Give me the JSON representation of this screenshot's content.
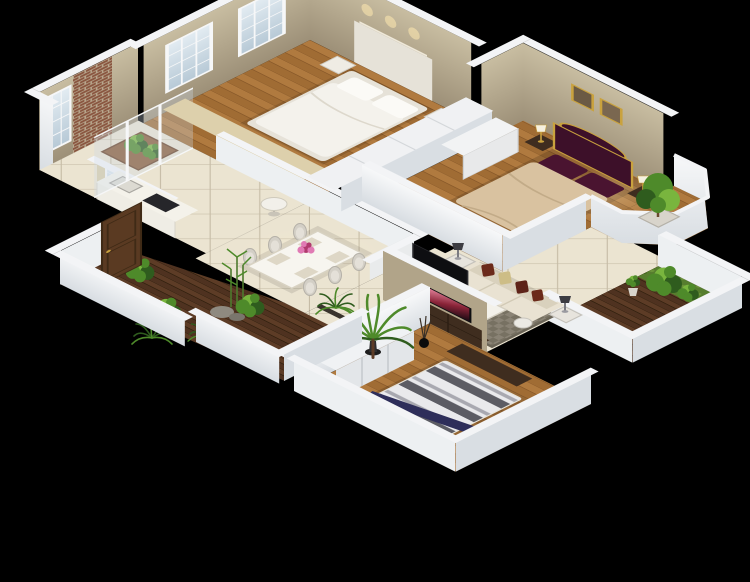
{
  "scene": {
    "description": "3D isometric cutaway render of a three-bedroom apartment floor plan on a black background",
    "rooms": [
      {
        "name": "kitchen-balcony",
        "features": [
          "brick-wall",
          "grid-windows",
          "counter-with-sink-and-cooktop",
          "planter-box",
          "glass-partition"
        ]
      },
      {
        "name": "bedroom-1",
        "features": [
          "white-double-bed",
          "two-grid-windows",
          "headboard-wall-with-downlights",
          "beige-low-cabinet"
        ]
      },
      {
        "name": "master-bedroom",
        "features": [
          "purple-ornate-headboard-bed",
          "tan-bedspread",
          "two-framed-pictures",
          "nightstands-with-lamps",
          "white-dresser"
        ]
      },
      {
        "name": "bay-balcony",
        "features": [
          "potted-tree",
          "white-parapet"
        ]
      },
      {
        "name": "dining-area",
        "features": [
          "white-dining-table",
          "six-upholstered-chairs",
          "magenta-flower-centerpiece",
          "half-walls",
          "round-breakfast-table"
        ]
      },
      {
        "name": "living-room",
        "features": [
          "cream-sofa",
          "chaise-lounge",
          "white-coffee-table",
          "pink-flower-bouquet",
          "gray-rug",
          "flat-screen-tv",
          "side-tables-with-lamps"
        ]
      },
      {
        "name": "bedroom-2",
        "features": [
          "striped-duvet-bed",
          "navy-bolster",
          "white-wardrobe",
          "tv-console-with-tv",
          "black-floor-vase"
        ]
      },
      {
        "name": "entrance-garden",
        "features": [
          "dark-wood-deck",
          "plants",
          "rocks",
          "brown-entry-door",
          "white-parapet-walls"
        ]
      },
      {
        "name": "side-balcony",
        "features": [
          "dark-wood-deck",
          "grass-strip",
          "potted-plants",
          "white-parapet"
        ]
      }
    ]
  },
  "colors": {
    "background": "#000000",
    "wall_top": "#f3f4f6",
    "wall_white": "#edf0f2",
    "wall_white_shade": "#d9dee3",
    "wall_taupe_light": "#c8bda1",
    "wall_taupe": "#b1a489",
    "wall_taupe_dark": "#9d9078",
    "brick": "#8a5640",
    "mortar": "#b9a88f",
    "glass": "#ccdae6",
    "frame_white": "#f6f7f8",
    "wood_floor": "#b07a3f",
    "wood_floor_dark": "#a06c34",
    "deck": "#5d3c26",
    "deck_dark": "#4f3220",
    "tile": "#ebe4d1",
    "tile_line": "#c6bca6",
    "rug": "#8a8375",
    "rug_dark": "#777162",
    "sofa_cream": "#e9e2d2",
    "sofa_shade": "#d9d1bd",
    "pillow_maroon": "#6b2a1a",
    "pillow_maroon_dark": "#5e2318",
    "pillow_gold": "#cdbd86",
    "bed_white": "#f4f2ec",
    "bed_frame": "#e6e2d8",
    "master_purple": "#3d1029",
    "master_pillow": "#4a1430",
    "master_tan": "#d9c2a0",
    "gold": "#c9a23e",
    "dark_wood": "#3f2d1f",
    "door_brown": "#5a3a22",
    "tv_black": "#0e0e11",
    "stripe_light": "#e9e9ec",
    "stripe_mid": "#a8a8b0",
    "stripe_dark": "#5c5c64",
    "bolster_navy": "#2e2e5a",
    "plant_dark": "#2f5c1e",
    "plant_mid": "#4e8a2a",
    "plant_light": "#79b53e",
    "grass": "#567d2e",
    "flower_pink": "#e07ab4",
    "flower_magenta": "#b03a6e",
    "pot_white": "#d8d4cb",
    "stone": "#8f8a80",
    "art_brown": "#6b5a44",
    "art_tan": "#7a6750",
    "counter_white": "#efede5",
    "cooktop": "#26262a",
    "chair_gray": "#d3cfc6",
    "lamp_dark": "#3c3c42",
    "lamp_white": "#f5f0e0"
  }
}
